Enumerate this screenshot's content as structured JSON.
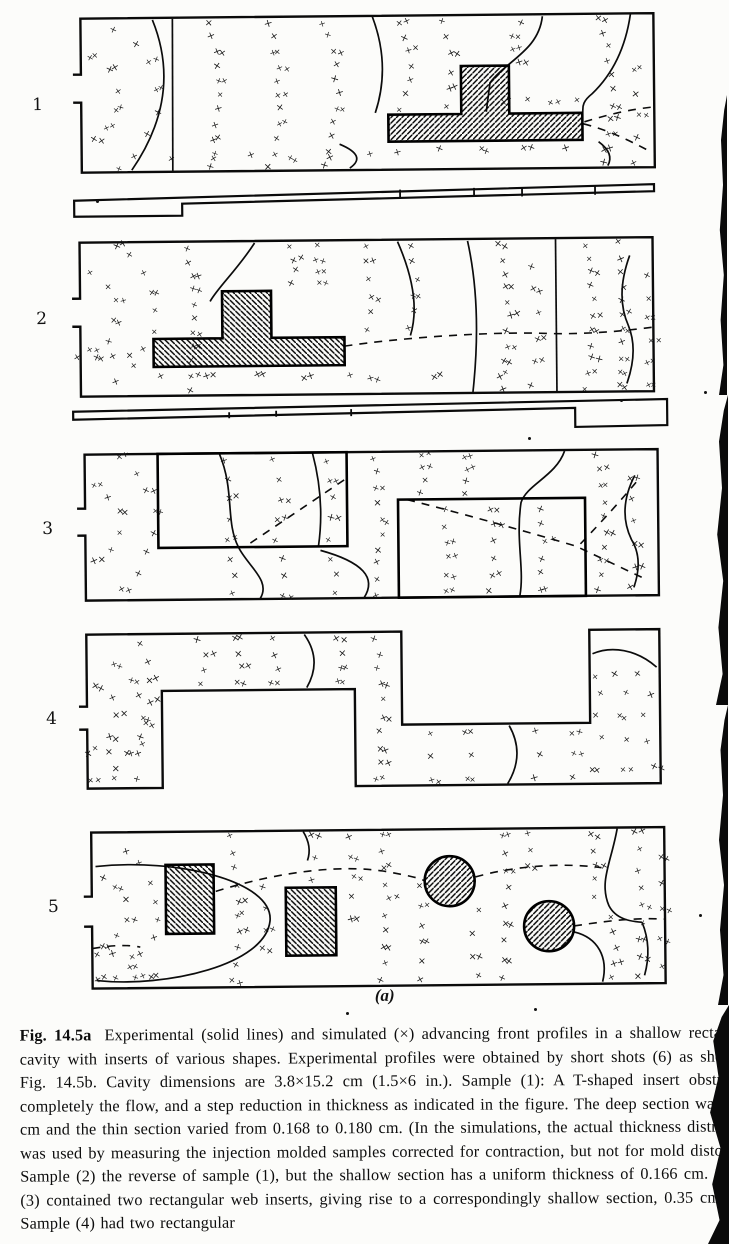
{
  "colors": {
    "paper": "#fcfcfa",
    "ink": "#0d0d0d"
  },
  "caption": {
    "fig_label": "Fig. 14.5a",
    "text": "Experimental (solid lines) and simulated (×) advancing front profiles in a shallow rectangular cavity with inserts of various shapes. Experimental profiles were obtained by short shots (6) as shown in Fig. 14.5b. Cavity dimensions are 3.8×15.2 cm (1.5×6 in.). Sample (1): A T-shaped insert obstructing completely the flow, and a step reduction in thickness as indicated in the figure. The deep section was 0.335 cm and the thin section varied from 0.168 to 0.180 cm. (In the simulations, the actual thickness distribution was used by measuring the injection molded samples corrected for contraction, but not for mold distortion.) Sample (2) the reverse of sample (1), but the shallow section has a uniform thickness of 0.166 cm. Sample (3) contained two rectangular web inserts, giving rise to a correspondingly shallow section, 0.35 cm thick. Sample (4) had two rectangular"
  },
  "figure": {
    "sub_label": "(a)",
    "x_marker": "×",
    "numbers": [
      {
        "label": "1",
        "x": 36,
        "y": 92
      },
      {
        "label": "2",
        "x": 38,
        "y": 306
      },
      {
        "label": "3",
        "x": 42,
        "y": 516
      },
      {
        "label": "4",
        "x": 44,
        "y": 706
      },
      {
        "label": "5",
        "x": 44,
        "y": 894
      }
    ],
    "panels": [
      {
        "label": "1",
        "x": 75,
        "y": 14,
        "w": 585,
        "h": 158,
        "gate": [
          58,
          86
        ],
        "inserts": [
          {
            "d": "M390 53 L438 53 L438 101 L511 101 L511 128 L317 128 L317 101 L390 101 Z",
            "hatch": "fwd"
          }
        ],
        "solid": [
          "M 82 4 Q 112 80 60 154",
          "M 102 3 L 101 155",
          "M 302 3 Q 320 52 304 99",
          "M 268 130 Q 296 142 278 154",
          "M 472 4 C 468 38 436 48 419 70 L 415 99",
          "M 560 3 C 554 42 538 66 521 82 C 508 92 513 98 511 101",
          "M 527 130 Q 543 142 536 154"
        ],
        "dashed": [
          "M 512 112 C 535 118 556 128 578 140",
          "M 513 110 C 540 102 560 98 580 96"
        ],
        "xarcs": [
          {
            "cx": 4,
            "cy": 84,
            "r": 44,
            "n": 6,
            "a0": -68,
            "a1": 68
          },
          {
            "cx": 4,
            "cy": 84,
            "r": 82,
            "n": 8,
            "a0": -60,
            "a1": 60
          }
        ],
        "xcols": [
          {
            "x": 140,
            "bow": 7,
            "n": 11,
            "y0": 8,
            "y1": 152
          },
          {
            "x": 198,
            "bow": 10,
            "n": 11,
            "y0": 8,
            "y1": 152
          },
          {
            "x": 254,
            "bow": 12,
            "n": 11,
            "y0": 8,
            "y1": 152
          },
          {
            "x": 330,
            "bow": 9,
            "n": 7,
            "y0": 8,
            "y1": 95
          },
          {
            "x": 373,
            "bow": 6,
            "n": 6,
            "y0": 8,
            "y1": 92
          },
          {
            "x": 450,
            "bow": -8,
            "n": 4,
            "y0": 10,
            "y1": 48
          },
          {
            "x": 530,
            "bow": 10,
            "n": 11,
            "y0": 6,
            "y1": 152
          },
          {
            "x": 562,
            "bow": 6,
            "n": 5,
            "y0": 60,
            "y1": 150
          }
        ],
        "xrows": [
          {
            "y": 88,
            "x0": 432,
            "x1": 505,
            "n": 4
          },
          {
            "y": 142,
            "x0": 100,
            "x1": 300,
            "n": 6
          },
          {
            "y": 138,
            "x0": 325,
            "x1": 495,
            "n": 5
          }
        ]
      },
      {
        "label": "2",
        "x": 72,
        "y": 238,
        "w": 585,
        "h": 158,
        "gate": [
          58,
          86
        ],
        "inserts": [
          {
            "d": "M152 52 L201 52 L201 99 L274 99 L274 127 L83 127 L83 99 L152 99 Z",
            "hatch": "back"
          }
        ],
        "solid": [
          "M 185 4 C 168 30 148 48 140 62",
          "M 328 4 Q 352 60 340 98",
          "M 398 4 Q 412 70 402 155",
          "M 486 3 L 486 155",
          "M 560 20 Q 545 60 558 90 Q 568 115 556 148"
        ],
        "dashed": [
          "M 274 108 C 330 100 420 95 470 97 C 510 99 550 96 582 92"
        ],
        "xarcs": [
          {
            "cx": 4,
            "cy": 72,
            "r": 42,
            "n": 6,
            "a0": -66,
            "a1": 66
          },
          {
            "cx": 4,
            "cy": 72,
            "r": 80,
            "n": 9,
            "a0": -58,
            "a1": 58
          }
        ],
        "xcols": [
          {
            "x": 118,
            "bow": 6,
            "n": 11,
            "y0": 8,
            "y1": 150
          },
          {
            "x": 222,
            "bow": 5,
            "n": 4,
            "y0": 8,
            "y1": 46
          },
          {
            "x": 250,
            "bow": -5,
            "n": 4,
            "y0": 8,
            "y1": 46
          },
          {
            "x": 296,
            "bow": 4,
            "n": 6,
            "y0": 8,
            "y1": 92
          },
          {
            "x": 340,
            "bow": 6,
            "n": 6,
            "y0": 8,
            "y1": 92
          },
          {
            "x": 430,
            "bow": 8,
            "n": 11,
            "y0": 8,
            "y1": 152
          },
          {
            "x": 462,
            "bow": 6,
            "n": 6,
            "y0": 30,
            "y1": 150
          },
          {
            "x": 515,
            "bow": 8,
            "n": 11,
            "y0": 8,
            "y1": 152
          },
          {
            "x": 548,
            "bow": 5,
            "n": 11,
            "y0": 8,
            "y1": 150
          },
          {
            "x": 576,
            "bow": 3,
            "n": 6,
            "y0": 40,
            "y1": 150
          }
        ],
        "xrows": [
          {
            "y": 117,
            "x0": 8,
            "x1": 60,
            "n": 4
          },
          {
            "y": 138,
            "x0": 90,
            "x1": 280,
            "n": 5
          },
          {
            "y": 141,
            "x0": 300,
            "x1": 430,
            "n": 3
          }
        ]
      },
      {
        "label": "3",
        "x": 75,
        "y": 450,
        "w": 585,
        "h": 150,
        "gate": [
          56,
          83
        ],
        "inserts": [
          {
            "d": "M83 2 L272 2 L272 96 L83 96 Z",
            "hatch": "none"
          },
          {
            "d": "M323 50 L510 50 L510 148 L323 148 Z",
            "hatch": "none"
          }
        ],
        "solid": [
          "M 145 3 C 160 40 150 70 163 96 C 172 115 196 130 184 148",
          "M 238 3 Q 250 50 243 96",
          "M 245 100 Q 308 118 288 148",
          "M 490 3 C 481 28 452 36 446 54 C 440 92 449 120 444 147",
          "M 560 28 Q 542 62 556 92 Q 568 112 558 140"
        ],
        "dashed": [
          "M 175 92 L 272 28",
          "M 332 50 C 400 68 460 86 500 98 L 566 130",
          "M 505 96 Q 540 60 562 34"
        ],
        "xarcs": [
          {
            "cx": 4,
            "cy": 70,
            "r": 40,
            "n": 6,
            "a0": -66,
            "a1": 66
          },
          {
            "cx": 4,
            "cy": 70,
            "r": 76,
            "n": 8,
            "a0": -58,
            "a1": 58
          }
        ],
        "xcols": [
          {
            "x": 150,
            "bow": 5,
            "n": 5,
            "y0": 10,
            "y1": 88
          },
          {
            "x": 200,
            "bow": 6,
            "n": 5,
            "y0": 10,
            "y1": 88
          },
          {
            "x": 252,
            "bow": 4,
            "n": 5,
            "y0": 10,
            "y1": 88
          },
          {
            "x": 155,
            "bow": 3,
            "n": 3,
            "y0": 108,
            "y1": 144
          },
          {
            "x": 205,
            "bow": 4,
            "n": 3,
            "y0": 108,
            "y1": 144
          },
          {
            "x": 257,
            "bow": 4,
            "n": 3,
            "y0": 108,
            "y1": 144
          },
          {
            "x": 300,
            "bow": 5,
            "n": 10,
            "y0": 8,
            "y1": 144
          },
          {
            "x": 345,
            "bow": 4,
            "n": 4,
            "y0": 8,
            "y1": 44
          },
          {
            "x": 390,
            "bow": 4,
            "n": 4,
            "y0": 8,
            "y1": 44
          },
          {
            "x": 368,
            "bow": 4,
            "n": 6,
            "y0": 60,
            "y1": 142
          },
          {
            "x": 415,
            "bow": 5,
            "n": 6,
            "y0": 60,
            "y1": 142
          },
          {
            "x": 463,
            "bow": 5,
            "n": 6,
            "y0": 60,
            "y1": 142
          },
          {
            "x": 522,
            "bow": 8,
            "n": 10,
            "y0": 8,
            "y1": 144
          },
          {
            "x": 556,
            "bow": 4,
            "n": 6,
            "y0": 30,
            "y1": 140
          }
        ],
        "xrows": []
      },
      {
        "label": "4",
        "x": 75,
        "y": 630,
        "w": 585,
        "h": 158,
        "outline": "M 2 97 L 10 97 L 10 156 L 85 156 L 85 59 L 278 59 L 278 156 L 583 156 L 583 2 L 513 2 L 513 95 L 325 95 L 325 2 L 10 2 L 10 74 L 2 74",
        "inserts": [],
        "solid": [
          "M 228 4 Q 246 30 230 57",
          "M 432 97 Q 448 126 430 155",
          "M 516 26 C 535 18 560 22 580 40"
        ],
        "dashed": [],
        "xarcs": [
          {
            "cx": 4,
            "cy": 85,
            "r": 36,
            "n": 5,
            "a0": -64,
            "a1": 64
          },
          {
            "cx": 4,
            "cy": 85,
            "r": 62,
            "n": 7,
            "a0": -55,
            "a1": 55
          }
        ],
        "xcols": [
          {
            "x": 122,
            "bow": 8,
            "n": 4,
            "y0": 8,
            "y1": 52
          },
          {
            "x": 158,
            "bow": 6,
            "n": 4,
            "y0": 8,
            "y1": 52
          },
          {
            "x": 196,
            "bow": 5,
            "n": 4,
            "y0": 8,
            "y1": 52
          },
          {
            "x": 262,
            "bow": 4,
            "n": 4,
            "y0": 8,
            "y1": 52
          },
          {
            "x": 300,
            "bow": 4,
            "n": 10,
            "y0": 8,
            "y1": 150
          },
          {
            "x": 352,
            "bow": 3,
            "n": 3,
            "y0": 104,
            "y1": 150
          },
          {
            "x": 390,
            "bow": 4,
            "n": 3,
            "y0": 104,
            "y1": 150
          },
          {
            "x": 458,
            "bow": 4,
            "n": 3,
            "y0": 104,
            "y1": 150
          },
          {
            "x": 495,
            "bow": 3,
            "n": 3,
            "y0": 104,
            "y1": 150
          },
          {
            "x": 66,
            "bow": 9,
            "n": 6,
            "y0": 10,
            "y1": 110
          }
        ],
        "xrows": [
          {
            "y": 120,
            "x0": 12,
            "x1": 50,
            "n": 3
          },
          {
            "y": 148,
            "x0": 12,
            "x1": 60,
            "n": 3
          },
          {
            "y": 48,
            "x0": 518,
            "x1": 560,
            "n": 3
          },
          {
            "y": 66,
            "x0": 525,
            "x1": 575,
            "n": 3
          },
          {
            "y": 88,
            "x0": 520,
            "x1": 565,
            "n": 3
          },
          {
            "y": 112,
            "x0": 525,
            "x1": 570,
            "n": 3
          },
          {
            "y": 140,
            "x0": 515,
            "x1": 575,
            "n": 3
          }
        ]
      },
      {
        "label": "5",
        "x": 78,
        "y": 828,
        "w": 585,
        "h": 160,
        "gate": [
          66,
          96
        ],
        "inserts": [
          {
            "d": "M84 35 L132 35 L132 104 L84 104 Z",
            "hatch": "back"
          },
          {
            "d": "M204 59 L254 59 L254 127 L204 127 Z",
            "hatch": "back"
          },
          {
            "circle": [
              368,
              54,
              25
            ],
            "hatch": "fwd"
          },
          {
            "circle": [
              467,
              100,
              25
            ],
            "hatch": "fwd"
          }
        ],
        "solid": [
          "M 14 36 C 95 28 192 52 188 92 C 183 136 84 158 14 150",
          "M 222 3 Q 231 18 226 32",
          "M 536 3 C 530 36 517 56 527 80 C 534 94 549 96 560 97",
          "M 492 106 C 516 112 526 132 520 156",
          "M 560 97 Q 570 122 562 150"
        ],
        "dashed": [
          "M 134 62 C 200 42 262 36 306 44 C 326 48 336 50 342 53",
          "M 394 50 C 430 40 480 36 520 42",
          "M 492 100 C 520 96 550 92 582 94",
          "M 10 118 Q 40 113 58 117"
        ],
        "xarcs": [
          {
            "cx": 6,
            "cy": 80,
            "r": 38,
            "n": 6,
            "a0": -64,
            "a1": 64
          },
          {
            "cx": 6,
            "cy": 80,
            "r": 70,
            "n": 8,
            "a0": -56,
            "a1": 56
          }
        ],
        "xcols": [
          {
            "x": 150,
            "bow": 6,
            "n": 10,
            "y0": 8,
            "y1": 150
          },
          {
            "x": 182,
            "bow": 4,
            "n": 4,
            "y0": 60,
            "y1": 120
          },
          {
            "x": 230,
            "bow": 3,
            "n": 3,
            "y0": 8,
            "y1": 50
          },
          {
            "x": 268,
            "bow": 4,
            "n": 5,
            "y0": 8,
            "y1": 90
          },
          {
            "x": 300,
            "bow": 5,
            "n": 10,
            "y0": 8,
            "y1": 152
          },
          {
            "x": 336,
            "bow": 4,
            "n": 6,
            "y0": 60,
            "y1": 152
          },
          {
            "x": 395,
            "bow": -6,
            "n": 4,
            "y0": 85,
            "y1": 150
          },
          {
            "x": 420,
            "bow": 5,
            "n": 9,
            "y0": 8,
            "y1": 150
          },
          {
            "x": 448,
            "bow": 3,
            "n": 3,
            "y0": 8,
            "y1": 40
          },
          {
            "x": 510,
            "bow": 6,
            "n": 5,
            "y0": 8,
            "y1": 70
          },
          {
            "x": 528,
            "bow": 5,
            "n": 5,
            "y0": 90,
            "y1": 152
          },
          {
            "x": 555,
            "bow": 4,
            "n": 9,
            "y0": 8,
            "y1": 150
          },
          {
            "x": 578,
            "bow": 2,
            "n": 5,
            "y0": 30,
            "y1": 140
          }
        ],
        "xrows": [
          {
            "y": 148,
            "x0": 14,
            "x1": 70,
            "n": 4
          },
          {
            "y": 125,
            "x0": 14,
            "x1": 50,
            "n": 3
          }
        ]
      }
    ],
    "bars": [
      {
        "x": 75,
        "y": 184,
        "w": 588,
        "h": 34,
        "path": "M 2 14 L 582 3 L 582 10 L 110 18 L 110 30 L 2 30 Z",
        "dividers": [
          [
            328,
            6,
            328,
            15
          ],
          [
            402,
            5,
            402,
            14
          ],
          [
            450,
            5,
            450,
            14
          ],
          [
            523,
            4,
            523,
            13
          ]
        ]
      },
      {
        "x": 72,
        "y": 400,
        "w": 600,
        "h": 34,
        "path": "M 2 9 L 596 2 L 596 28 L 504 29 L 504 10 L 2 17 Z",
        "dividers": [
          [
            158,
            11,
            158,
            17
          ],
          [
            205,
            10,
            205,
            16
          ],
          [
            280,
            9,
            280,
            16
          ]
        ]
      }
    ],
    "artifacts": {
      "edge_segments": [
        {
          "x": 719,
          "y": 95,
          "w": 8,
          "h": 300
        },
        {
          "x": 716,
          "y": 395,
          "w": 12,
          "h": 310
        },
        {
          "x": 718,
          "y": 705,
          "w": 10,
          "h": 300
        },
        {
          "x": 708,
          "y": 1005,
          "w": 21,
          "h": 239
        }
      ],
      "specks": [
        [
          528,
          437
        ],
        [
          346,
          1012
        ],
        [
          620,
          399
        ],
        [
          704,
          391
        ],
        [
          699,
          914
        ],
        [
          534,
          1008
        ],
        [
          96,
          200
        ]
      ]
    }
  }
}
